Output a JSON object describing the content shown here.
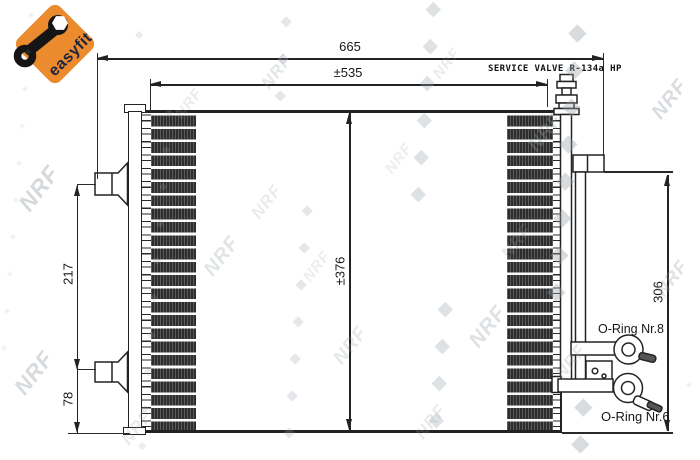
{
  "badge": {
    "easyfit_label": "easyfit",
    "orange": "#EC8B2D",
    "navy": "#1D2440"
  },
  "annotations": {
    "service_valve": "SERVICE VALVE R-134a HP",
    "oring_top": "O-Ring Nr.8",
    "oring_bottom": "O-Ring Nr.6"
  },
  "dimensions": {
    "overall_width": "665",
    "valve_span": "±535",
    "core_height": "±376",
    "bracket_upper_span": "217",
    "bracket_lower_span": "78",
    "right_side_height": "306"
  },
  "watermark": {
    "text": "NRF"
  },
  "colors": {
    "line": "#222222",
    "fin_dark": "#2D2D2D"
  }
}
